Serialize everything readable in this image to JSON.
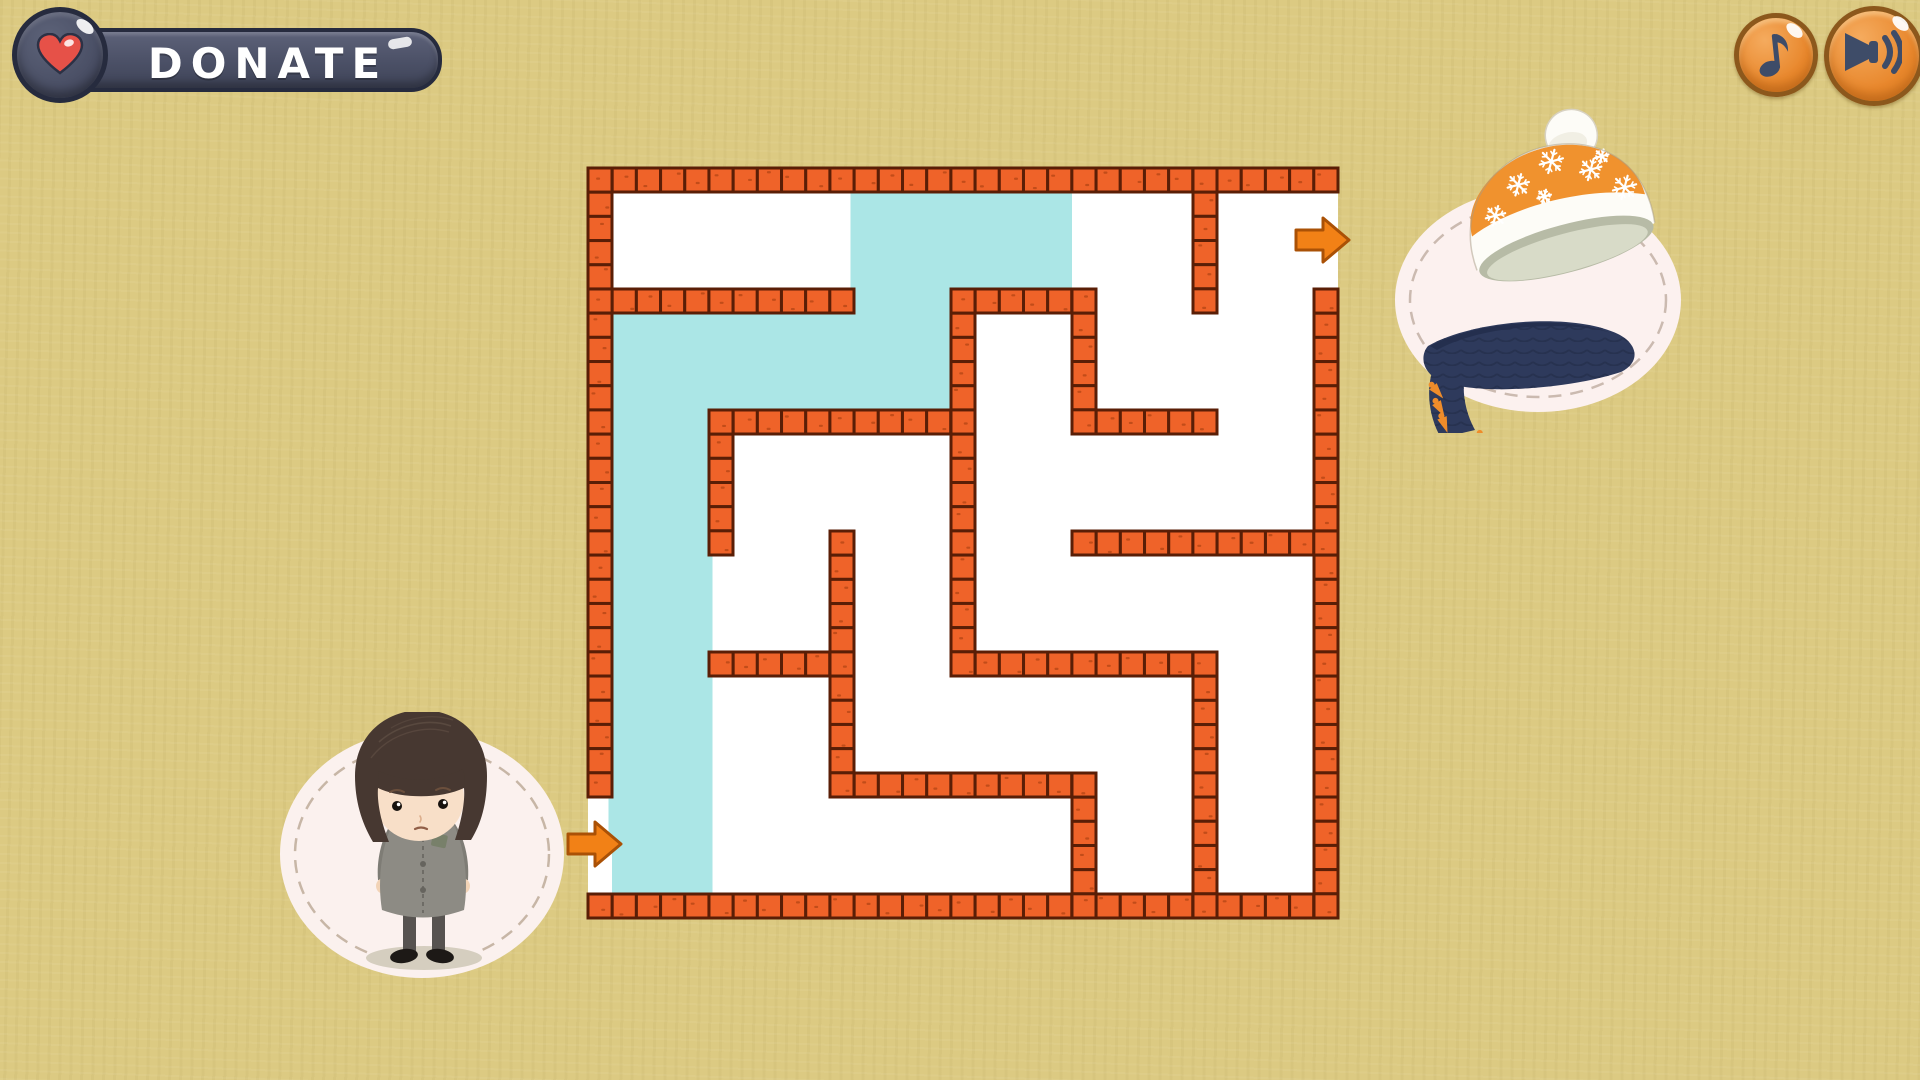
{
  "page": {
    "bg_color": "#dcca82"
  },
  "donate_button": {
    "label": "DONATE",
    "pill_color": "#4b5066",
    "border_color": "#262b3e",
    "text_color": "#ffffff",
    "heart_color": "#e65148"
  },
  "audio_controls": {
    "music_button": {
      "icon": "music-note-icon",
      "fill": "#e8872c",
      "rim": "#8c581c",
      "icon_color": "#3e4c68"
    },
    "sound_button": {
      "icon": "speaker-icon",
      "fill": "#e8872c",
      "rim": "#8c581c",
      "icon_color": "#3e4c68"
    }
  },
  "maze": {
    "x": 588,
    "y": 168,
    "cols": 6,
    "rows": 6,
    "pitch": 121,
    "wall_thickness": 24,
    "colors": {
      "floor": "#ffffff",
      "brick": "#ef6329",
      "mortar": "#5a1e06",
      "speck": "#9c3a0c",
      "path": "#abe6e6",
      "arrow": "#f28116",
      "arrow_border": "#aa5106"
    },
    "outer_walls": {
      "top_cols": [
        0,
        5
      ],
      "bottom_cols": [
        0,
        5
      ],
      "left_rows": [
        0,
        4
      ],
      "right_rows": [
        1,
        5
      ]
    },
    "h_walls": [
      [
        1,
        0,
        1
      ],
      [
        1,
        3,
        3
      ],
      [
        2,
        1,
        2
      ],
      [
        2,
        4,
        4
      ],
      [
        3,
        4,
        5
      ],
      [
        4,
        1,
        1
      ],
      [
        4,
        3,
        4
      ],
      [
        5,
        2,
        3
      ]
    ],
    "v_walls": [
      [
        1,
        2,
        2
      ],
      [
        2,
        3,
        4
      ],
      [
        3,
        1,
        3
      ],
      [
        4,
        1,
        1
      ],
      [
        4,
        5,
        5
      ],
      [
        5,
        0,
        0
      ],
      [
        5,
        4,
        5
      ]
    ],
    "entrance": {
      "side": "left",
      "row": 5,
      "arrow_x": 568,
      "arrow_cy": 844
    },
    "exit": {
      "side": "right",
      "row": 0,
      "arrow_x": 1296,
      "arrow_cy": 240
    },
    "traced_path_cells": [
      [
        5,
        0
      ],
      [
        4,
        0
      ],
      [
        3,
        0
      ],
      [
        2,
        0
      ],
      [
        1,
        0
      ],
      [
        1,
        1
      ],
      [
        1,
        2
      ],
      [
        0,
        2
      ],
      [
        0,
        3
      ]
    ],
    "path_width": 104
  },
  "girl": {
    "colors": {
      "blob": "#fbf1ee",
      "blob_dash": "#c7b6a6",
      "shadow": "#d5cebf",
      "hair": "#473831",
      "hair_streak": "#5e4d43",
      "skin": "#f8dfc8",
      "coat": "#8d8b84",
      "coat_dark": "#7e7c75",
      "tights": "#575350",
      "shoes": "#1d1916",
      "hands": "#f2d3b6",
      "patch": "#78806a"
    }
  },
  "prize": {
    "colors": {
      "blob": "#fcf1ef",
      "blob_dash": "#cbbab0",
      "hat_white": "#fdfcf7",
      "hat_inside": "#d8dbc8",
      "hat_inside_dark": "#b7bba6",
      "band": "#f0922e",
      "pompom_shade": "#e8e4d6",
      "outline": "#a79c86",
      "scarf": "#2e3a5c",
      "scarf_dark": "#242e4d",
      "knit": "#26304e",
      "tassel": "#ef8c2a",
      "snowflake": "#ffffff"
    },
    "snowflakes": [
      [
        -60,
        -6,
        10
      ],
      [
        -30,
        -30,
        11
      ],
      [
        8,
        -44,
        12
      ],
      [
        44,
        -26,
        11
      ],
      [
        72,
        0,
        12
      ],
      [
        -8,
        -12,
        7
      ],
      [
        58,
        -36,
        7
      ]
    ],
    "tassels": [
      [
        -102,
        18,
        -40
      ],
      [
        -98,
        34,
        -30
      ],
      [
        -92,
        49,
        -20
      ],
      [
        -88,
        74,
        -6
      ],
      [
        -76,
        78,
        0
      ],
      [
        -64,
        74,
        6
      ],
      [
        -53,
        66,
        14
      ]
    ]
  }
}
